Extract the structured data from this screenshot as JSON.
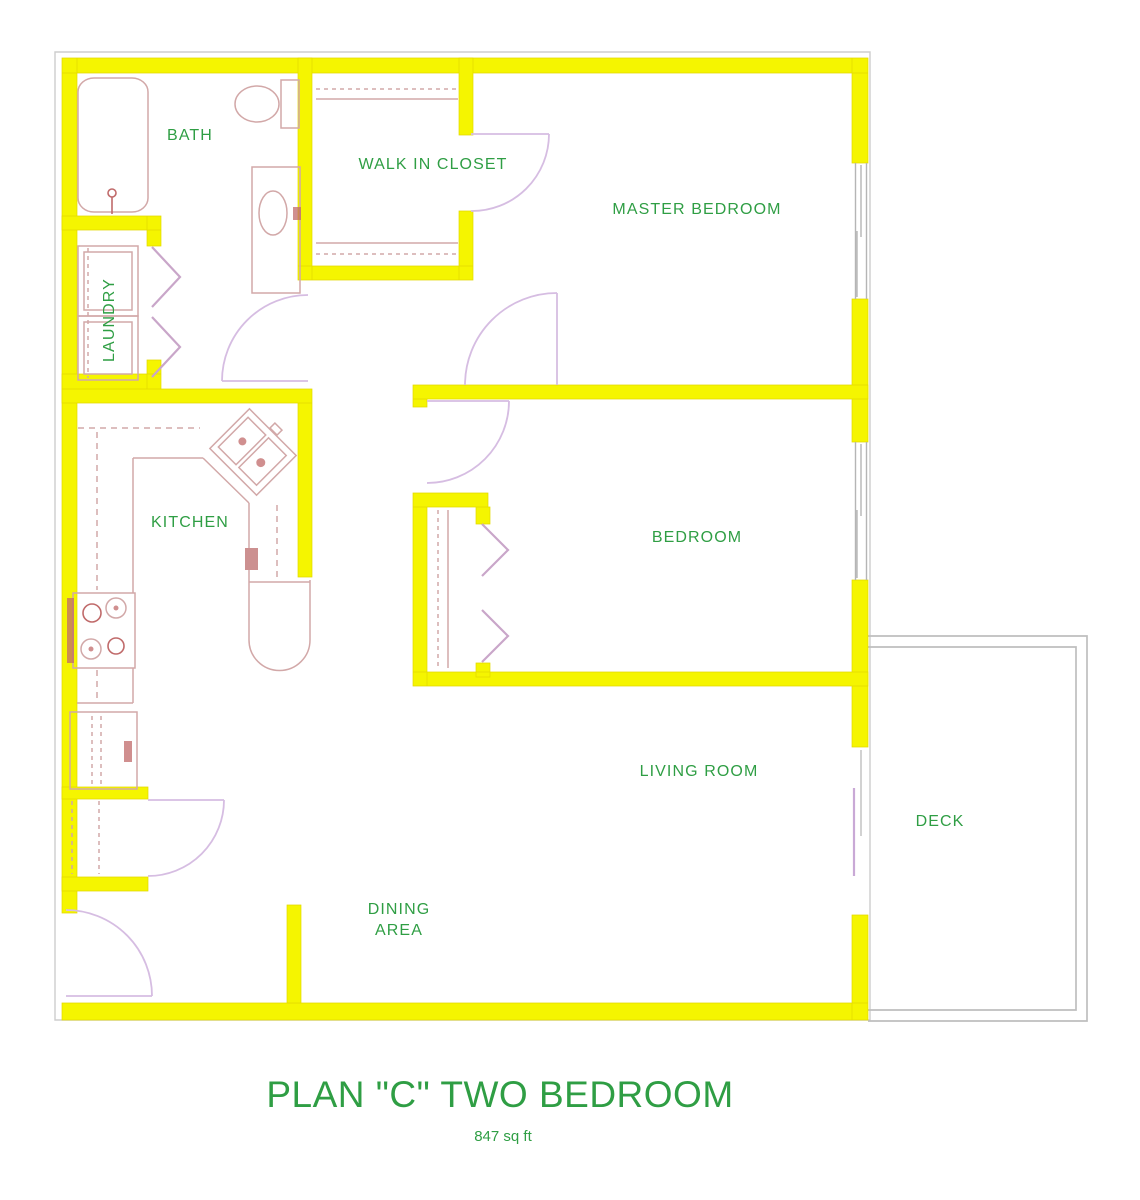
{
  "plan": {
    "title": "PLAN \"C\" TWO BEDROOM",
    "area_label": "847 sq ft"
  },
  "rooms": {
    "bath": {
      "label": "BATH"
    },
    "laundry": {
      "label": "LAUNDRY"
    },
    "walk_in_closet": {
      "label": "WALK IN CLOSET"
    },
    "master_bedroom": {
      "label": "MASTER BEDROOM"
    },
    "kitchen": {
      "label": "KITCHEN"
    },
    "bedroom": {
      "label": "BEDROOM"
    },
    "living_room": {
      "label": "LIVING ROOM"
    },
    "dining_area": {
      "line1": "DINING",
      "line2": "AREA"
    },
    "deck": {
      "label": "DECK"
    }
  },
  "colors": {
    "wall": "#f5f500",
    "text_green": "#2f9e44",
    "fixture": "#d2a8a8",
    "fixture_dark": "#c06a6a",
    "door": "#d6bde2",
    "bifold": "#c9a6c9",
    "slider": "#c9a9d6",
    "deck_outline": "#bebebe",
    "window": "#b5b5b5",
    "frame": "#cdcdcd",
    "background": "#ffffff"
  }
}
